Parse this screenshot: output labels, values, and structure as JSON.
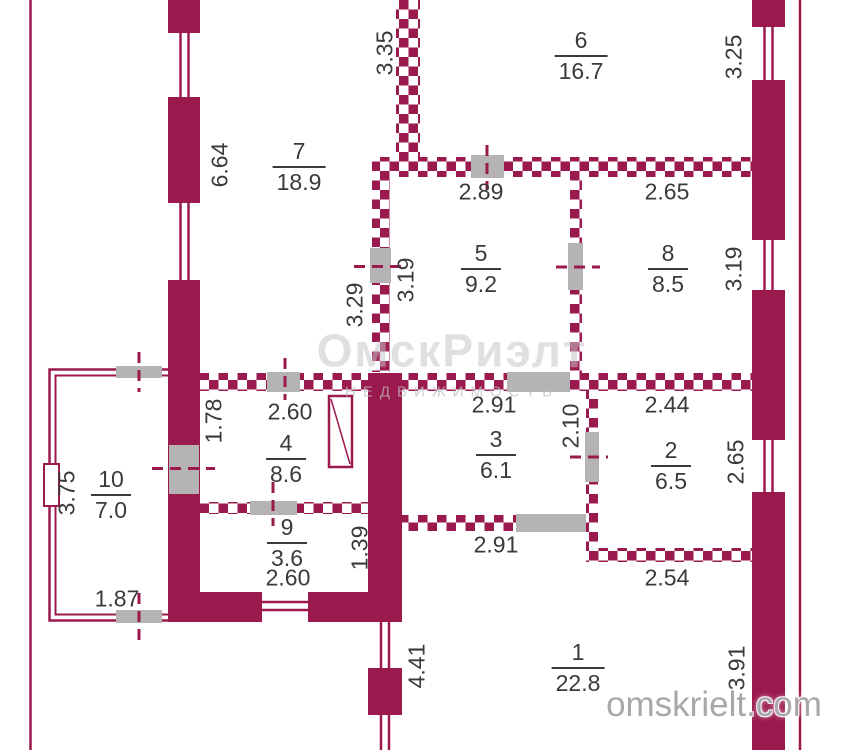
{
  "colors": {
    "wall": "#9b1a4e",
    "door_opening": "#b5b3b4",
    "label_text": "#3a3a3c",
    "watermark_gray": "#a9a7ab",
    "background": "#ffffff"
  },
  "watermarks": {
    "corner": "omskrielt.com",
    "center_line1": "ОмскРиэлт",
    "center_line2": "НЕДВИЖИМОСТЬ"
  },
  "rooms": [
    {
      "number": "1",
      "area": "22.8"
    },
    {
      "number": "2",
      "area": "6.5"
    },
    {
      "number": "3",
      "area": "6.1"
    },
    {
      "number": "4",
      "area": "8.6"
    },
    {
      "number": "5",
      "area": "9.2"
    },
    {
      "number": "6",
      "area": "16.7"
    },
    {
      "number": "7",
      "area": "18.9"
    },
    {
      "number": "8",
      "area": "8.5"
    },
    {
      "number": "9",
      "area": "3.6"
    },
    {
      "number": "10",
      "area": "7.0"
    }
  ],
  "dim_labels": [
    {
      "value": "6.64",
      "orientation": "vertical",
      "near": "room 7 left wall"
    },
    {
      "value": "3.35",
      "orientation": "vertical",
      "near": "top partition left of room 6"
    },
    {
      "value": "3.25",
      "orientation": "vertical",
      "near": "room 6 right wall"
    },
    {
      "value": "2.89",
      "orientation": "horizontal",
      "near": "room 5 top"
    },
    {
      "value": "2.65",
      "orientation": "horizontal",
      "near": "room 8 top"
    },
    {
      "value": "3.29",
      "orientation": "vertical",
      "near": "room 7 side of door to room 5"
    },
    {
      "value": "3.19",
      "orientation": "vertical",
      "near": "room 5 left"
    },
    {
      "value": "3.19",
      "orientation": "vertical",
      "near": "room 8 right"
    },
    {
      "value": "1.78",
      "orientation": "vertical",
      "near": "room 4 left"
    },
    {
      "value": "2.60",
      "orientation": "horizontal",
      "near": "room 4 top"
    },
    {
      "value": "2.91",
      "orientation": "horizontal",
      "near": "room 3 top"
    },
    {
      "value": "2.10",
      "orientation": "vertical",
      "near": "door between rooms 3 and 2"
    },
    {
      "value": "2.44",
      "orientation": "horizontal",
      "near": "room 2 top"
    },
    {
      "value": "3.75",
      "orientation": "vertical",
      "near": "room 10 left"
    },
    {
      "value": "2.65",
      "orientation": "vertical",
      "near": "room 2 right"
    },
    {
      "value": "1.87",
      "orientation": "horizontal",
      "near": "room 10 bottom"
    },
    {
      "value": "2.60",
      "orientation": "horizontal",
      "near": "room 9 bottom"
    },
    {
      "value": "1.39",
      "orientation": "vertical",
      "near": "room 9 right"
    },
    {
      "value": "2.91",
      "orientation": "horizontal",
      "near": "room 3 bottom"
    },
    {
      "value": "2.54",
      "orientation": "horizontal",
      "near": "room 2 bottom"
    },
    {
      "value": "4.41",
      "orientation": "vertical",
      "near": "room 1 left wall"
    },
    {
      "value": "3.91",
      "orientation": "vertical",
      "near": "room 1 right wall"
    }
  ]
}
